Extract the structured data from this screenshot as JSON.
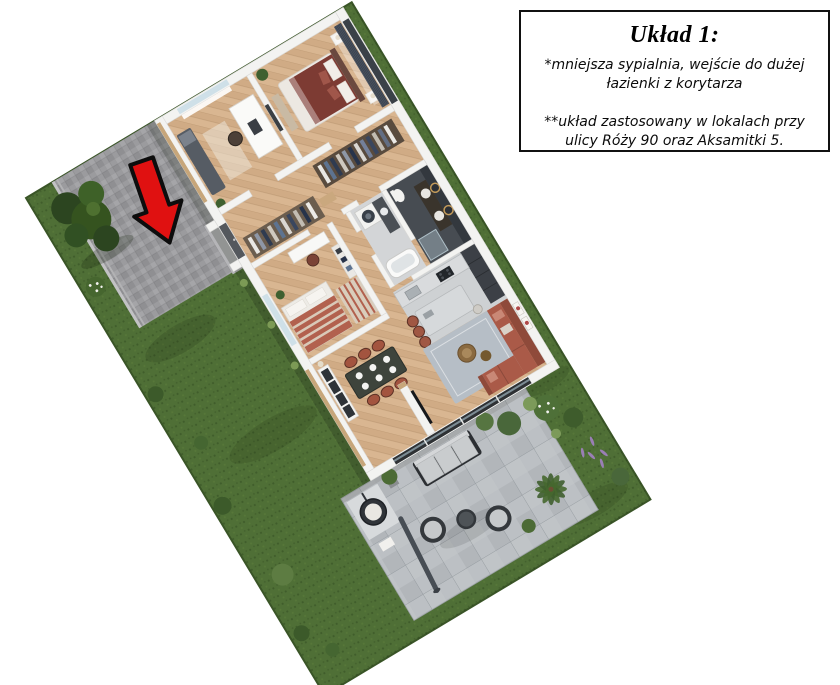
{
  "annotation_box": {
    "title": "Układ 1:",
    "note1_lines": [
      "*mniejsza sypialnia, wejście do dużej",
      "łazienki z korytarza"
    ],
    "note2_lines": [
      "**układ zastosowany w lokalach przy",
      "ulicy Róży 90 oraz Aksamitki 5."
    ]
  },
  "markers": {
    "entrance_arrow": "red-arrow-icon pointing to the apartment entrance"
  },
  "colors": {
    "ink": "#111111",
    "grass": "#4f6f36",
    "grass_dark": "#3a5527",
    "paver": "#9b9b9e",
    "tile": "#bcc0c4",
    "wall": "#f3f3f1",
    "wood_floor": "#d9b691",
    "wood_trim": "#c7a67a",
    "charcoal": "#3c4046",
    "slate_curtain": "#4b5461",
    "bed_maroon": "#7d3b33",
    "sofa": "#aa5a48",
    "rug": "#b6bec6",
    "arrow_red": "#e01111",
    "glass": "#cfe0e8",
    "bath_dark": "#474c52",
    "gold": "#c29a5a"
  }
}
